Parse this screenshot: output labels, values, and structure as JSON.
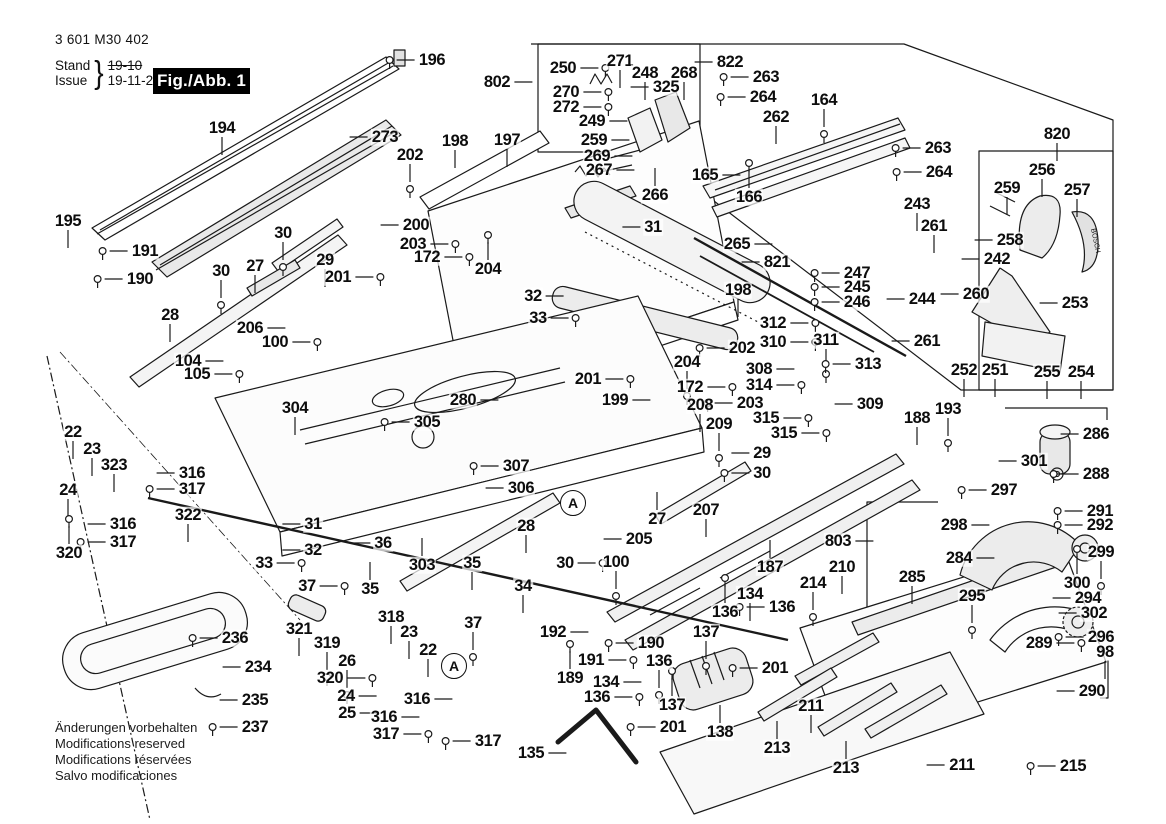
{
  "doc": {
    "part_number": "3 601 M30 402",
    "stand_label": "Stand",
    "issue_label": "Issue",
    "stand_value": "19-10",
    "issue_value": "19-11-28",
    "figure_label": "Fig./Abb. 1",
    "brand_text_on_part": "BOSCH",
    "footer_lines": [
      "Änderungen vorbehalten",
      "Modifications reserved",
      "Modifications réservées",
      "Salvo modificaciones"
    ]
  },
  "colors": {
    "ink": "#1a1a1a",
    "fig_bg": "#000000",
    "fig_fg": "#ffffff",
    "paper": "#ffffff"
  },
  "markers": [
    {
      "t": "A",
      "x": 573,
      "y": 503
    },
    {
      "t": "A",
      "x": 454,
      "y": 666
    }
  ],
  "callouts": [
    [
      "194",
      222,
      128,
      "d",
      0
    ],
    [
      "196",
      432,
      60,
      "l",
      1
    ],
    [
      "273",
      385,
      137,
      "l",
      0
    ],
    [
      "202",
      410,
      155,
      "d",
      1
    ],
    [
      "195",
      68,
      221,
      "d",
      0
    ],
    [
      "191",
      145,
      251,
      "l",
      1
    ],
    [
      "190",
      140,
      279,
      "l",
      1
    ],
    [
      "30",
      283,
      233,
      "d",
      1
    ],
    [
      "29",
      325,
      260,
      "d",
      0
    ],
    [
      "27",
      255,
      266,
      "d",
      0
    ],
    [
      "30",
      221,
      271,
      "d",
      1
    ],
    [
      "201",
      338,
      277,
      "r",
      1
    ],
    [
      "28",
      170,
      315,
      "d",
      0
    ],
    [
      "206",
      250,
      328,
      "r",
      0
    ],
    [
      "100",
      275,
      342,
      "r",
      1
    ],
    [
      "104",
      188,
      361,
      "r",
      0
    ],
    [
      "105",
      197,
      374,
      "r",
      1
    ],
    [
      "198",
      455,
      141,
      "d",
      0
    ],
    [
      "197",
      507,
      140,
      "d",
      0
    ],
    [
      "200",
      416,
      225,
      "l",
      0
    ],
    [
      "203",
      413,
      244,
      "r",
      1
    ],
    [
      "172",
      427,
      257,
      "r",
      1
    ],
    [
      "204",
      488,
      269,
      "u",
      1
    ],
    [
      "31",
      653,
      227,
      "l",
      0
    ],
    [
      "32",
      533,
      296,
      "r",
      0
    ],
    [
      "33",
      538,
      318,
      "r",
      1
    ],
    [
      "802",
      497,
      82,
      "r",
      0
    ],
    [
      "250",
      563,
      68,
      "r",
      1
    ],
    [
      "271",
      620,
      61,
      "d",
      0
    ],
    [
      "248",
      645,
      73,
      "d",
      0
    ],
    [
      "268",
      684,
      73,
      "d",
      0
    ],
    [
      "325",
      666,
      87,
      "l",
      0
    ],
    [
      "822",
      730,
      62,
      "l",
      0
    ],
    [
      "263",
      766,
      77,
      "l",
      1
    ],
    [
      "264",
      763,
      97,
      "l",
      1
    ],
    [
      "270",
      566,
      92,
      "r",
      1
    ],
    [
      "272",
      566,
      107,
      "r",
      1
    ],
    [
      "249",
      592,
      121,
      "r",
      0
    ],
    [
      "259",
      594,
      140,
      "r",
      0
    ],
    [
      "269",
      597,
      156,
      "r",
      0
    ],
    [
      "267",
      599,
      170,
      "r",
      0
    ],
    [
      "266",
      655,
      195,
      "u",
      0
    ],
    [
      "164",
      824,
      100,
      "d",
      1
    ],
    [
      "262",
      776,
      117,
      "d",
      0
    ],
    [
      "165",
      705,
      175,
      "r",
      0
    ],
    [
      "166",
      749,
      197,
      "u",
      1
    ],
    [
      "820",
      1057,
      134,
      "d",
      0
    ],
    [
      "263",
      938,
      148,
      "l",
      1
    ],
    [
      "264",
      939,
      172,
      "l",
      1
    ],
    [
      "243",
      917,
      204,
      "d",
      0
    ],
    [
      "256",
      1042,
      170,
      "d",
      0
    ],
    [
      "259",
      1007,
      188,
      "d",
      0
    ],
    [
      "257",
      1077,
      190,
      "d",
      0
    ],
    [
      "261",
      934,
      226,
      "d",
      0
    ],
    [
      "258",
      1010,
      240,
      "l",
      0
    ],
    [
      "242",
      997,
      259,
      "l",
      0
    ],
    [
      "260",
      976,
      294,
      "l",
      0
    ],
    [
      "244",
      922,
      299,
      "l",
      0
    ],
    [
      "261",
      927,
      341,
      "l",
      0
    ],
    [
      "253",
      1075,
      303,
      "l",
      0
    ],
    [
      "252",
      964,
      370,
      "d",
      0
    ],
    [
      "251",
      995,
      370,
      "d",
      0
    ],
    [
      "255",
      1047,
      372,
      "d",
      0
    ],
    [
      "254",
      1081,
      372,
      "d",
      0
    ],
    [
      "247",
      857,
      273,
      "l",
      1
    ],
    [
      "245",
      857,
      287,
      "l",
      1
    ],
    [
      "246",
      857,
      302,
      "l",
      1
    ],
    [
      "265",
      737,
      244,
      "r",
      0
    ],
    [
      "821",
      777,
      262,
      "l",
      0
    ],
    [
      "198",
      738,
      290,
      "d",
      0
    ],
    [
      "202",
      742,
      348,
      "l",
      1
    ],
    [
      "204",
      687,
      362,
      "d",
      1
    ],
    [
      "172",
      690,
      387,
      "r",
      1
    ],
    [
      "203",
      750,
      403,
      "l",
      1
    ],
    [
      "201",
      588,
      379,
      "r",
      1
    ],
    [
      "199",
      615,
      400,
      "r",
      0
    ],
    [
      "208",
      700,
      405,
      "d",
      0
    ],
    [
      "209",
      719,
      424,
      "d",
      1
    ],
    [
      "312",
      773,
      323,
      "r",
      1
    ],
    [
      "310",
      773,
      342,
      "r",
      1
    ],
    [
      "311",
      826,
      340,
      "d",
      1
    ],
    [
      "313",
      868,
      364,
      "l",
      1
    ],
    [
      "308",
      759,
      369,
      "r",
      0
    ],
    [
      "314",
      759,
      385,
      "r",
      1
    ],
    [
      "315",
      766,
      418,
      "r",
      1
    ],
    [
      "315",
      784,
      433,
      "r",
      1
    ],
    [
      "309",
      870,
      404,
      "l",
      0
    ],
    [
      "29",
      762,
      453,
      "l",
      0
    ],
    [
      "30",
      762,
      473,
      "l",
      1
    ],
    [
      "27",
      657,
      519,
      "u",
      0
    ],
    [
      "207",
      706,
      510,
      "d",
      0
    ],
    [
      "187",
      770,
      567,
      "u",
      0
    ],
    [
      "803",
      838,
      541,
      "r",
      0
    ],
    [
      "210",
      842,
      567,
      "d",
      0
    ],
    [
      "214",
      813,
      583,
      "d",
      1
    ],
    [
      "188",
      917,
      418,
      "d",
      0
    ],
    [
      "193",
      948,
      409,
      "d",
      1
    ],
    [
      "134",
      750,
      594,
      "d",
      0
    ],
    [
      "136",
      725,
      612,
      "u",
      1
    ],
    [
      "136",
      782,
      607,
      "l",
      1
    ],
    [
      "285",
      912,
      577,
      "d",
      0
    ],
    [
      "286",
      1096,
      434,
      "l",
      0
    ],
    [
      "301",
      1034,
      461,
      "l",
      0
    ],
    [
      "288",
      1096,
      474,
      "l",
      1
    ],
    [
      "297",
      1004,
      490,
      "l",
      1
    ],
    [
      "298",
      954,
      525,
      "r",
      0
    ],
    [
      "291",
      1100,
      511,
      "l",
      1
    ],
    [
      "292",
      1100,
      525,
      "l",
      1
    ],
    [
      "284",
      959,
      558,
      "r",
      0
    ],
    [
      "299",
      1101,
      552,
      "d",
      1
    ],
    [
      "300",
      1077,
      583,
      "u",
      1
    ],
    [
      "294",
      1088,
      598,
      "l",
      0
    ],
    [
      "302",
      1094,
      613,
      "l",
      0
    ],
    [
      "295",
      972,
      596,
      "d",
      1
    ],
    [
      "289",
      1039,
      643,
      "r",
      1
    ],
    [
      "296",
      1101,
      637,
      "l",
      1
    ],
    [
      "98",
      1105,
      652,
      "d",
      0
    ],
    [
      "290",
      1092,
      691,
      "l",
      0
    ],
    [
      "211",
      962,
      765,
      "l",
      0
    ],
    [
      "215",
      1073,
      766,
      "l",
      1
    ],
    [
      "304",
      295,
      408,
      "d",
      0
    ],
    [
      "305",
      427,
      422,
      "l",
      1
    ],
    [
      "280",
      463,
      400,
      "r",
      0
    ],
    [
      "307",
      516,
      466,
      "l",
      1
    ],
    [
      "306",
      521,
      488,
      "l",
      0
    ],
    [
      "303",
      422,
      565,
      "u",
      0
    ],
    [
      "36",
      383,
      543,
      "l",
      0
    ],
    [
      "35",
      370,
      589,
      "u",
      0
    ],
    [
      "35",
      472,
      563,
      "d",
      0
    ],
    [
      "34",
      523,
      586,
      "d",
      0
    ],
    [
      "28",
      526,
      526,
      "d",
      0
    ],
    [
      "30",
      565,
      563,
      "r",
      1
    ],
    [
      "100",
      616,
      562,
      "d",
      1
    ],
    [
      "205",
      639,
      539,
      "l",
      0
    ],
    [
      "31",
      313,
      524,
      "l",
      0
    ],
    [
      "32",
      313,
      550,
      "l",
      0
    ],
    [
      "33",
      264,
      563,
      "r",
      1
    ],
    [
      "37",
      307,
      586,
      "r",
      1
    ],
    [
      "37",
      473,
      623,
      "d",
      1
    ],
    [
      "22",
      73,
      432,
      "d",
      0
    ],
    [
      "23",
      92,
      449,
      "d",
      0
    ],
    [
      "323",
      114,
      465,
      "d",
      0
    ],
    [
      "24",
      68,
      490,
      "d",
      0
    ],
    [
      "316",
      192,
      473,
      "l",
      0
    ],
    [
      "317",
      192,
      489,
      "l",
      1
    ],
    [
      "316",
      123,
      524,
      "l",
      0
    ],
    [
      "317",
      123,
      542,
      "l",
      1
    ],
    [
      "320",
      69,
      553,
      "u",
      1
    ],
    [
      "322",
      188,
      515,
      "d",
      0
    ],
    [
      "321",
      299,
      629,
      "d",
      0
    ],
    [
      "319",
      327,
      643,
      "d",
      1
    ],
    [
      "26",
      347,
      661,
      "d",
      1
    ],
    [
      "320",
      330,
      678,
      "r",
      1
    ],
    [
      "24",
      346,
      696,
      "r",
      0
    ],
    [
      "25",
      347,
      713,
      "r",
      0
    ],
    [
      "318",
      391,
      617,
      "d",
      0
    ],
    [
      "23",
      409,
      632,
      "d",
      0
    ],
    [
      "22",
      428,
      650,
      "d",
      0
    ],
    [
      "316",
      417,
      699,
      "r",
      0
    ],
    [
      "316",
      384,
      717,
      "r",
      0
    ],
    [
      "317",
      386,
      734,
      "r",
      1
    ],
    [
      "317",
      488,
      741,
      "l",
      1
    ],
    [
      "236",
      235,
      638,
      "l",
      1
    ],
    [
      "234",
      258,
      667,
      "l",
      0
    ],
    [
      "235",
      255,
      700,
      "l",
      0
    ],
    [
      "237",
      255,
      727,
      "l",
      1
    ],
    [
      "192",
      553,
      632,
      "r",
      0
    ],
    [
      "190",
      651,
      643,
      "l",
      1
    ],
    [
      "191",
      591,
      660,
      "r",
      1
    ],
    [
      "189",
      570,
      678,
      "u",
      1
    ],
    [
      "136",
      659,
      661,
      "d",
      1
    ],
    [
      "134",
      606,
      682,
      "r",
      0
    ],
    [
      "136",
      597,
      697,
      "r",
      1
    ],
    [
      "137",
      672,
      705,
      "u",
      1
    ],
    [
      "137",
      706,
      632,
      "d",
      1
    ],
    [
      "201",
      673,
      727,
      "l",
      1
    ],
    [
      "201",
      775,
      668,
      "l",
      1
    ],
    [
      "135",
      531,
      753,
      "r",
      0
    ],
    [
      "138",
      720,
      732,
      "u",
      0
    ],
    [
      "211",
      811,
      706,
      "d",
      0
    ],
    [
      "213",
      777,
      748,
      "u",
      0
    ],
    [
      "213",
      846,
      768,
      "u",
      0
    ]
  ]
}
